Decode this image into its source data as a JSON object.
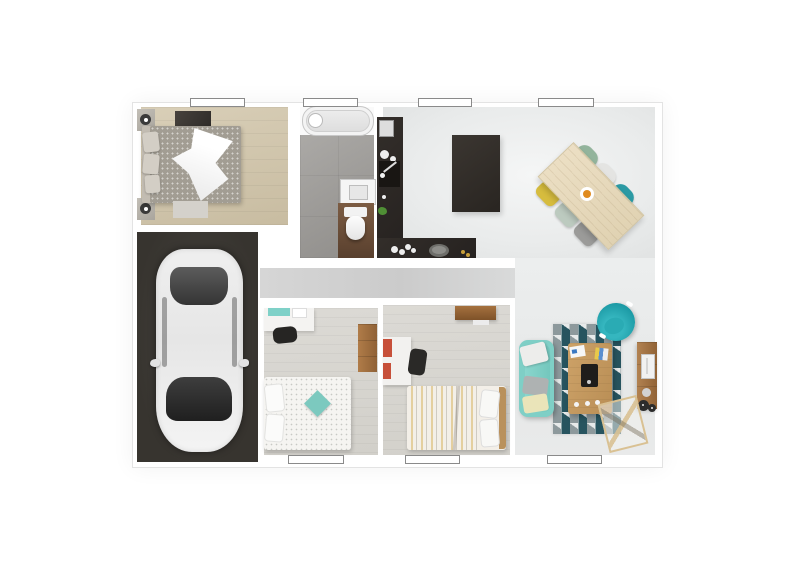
{
  "scene": {
    "type": "3d-floor-plan-render",
    "description": "Top-down 3D architectural render of a single-storey house with garage, no text labels",
    "rooms": [
      {
        "name": "bedroom-1",
        "floor": "light oak wood",
        "furniture": [
          "double-bed",
          "white-duvet",
          "nightstand-with-lamp-top",
          "nightstand-with-lamp-bottom",
          "dark-mat",
          "light-rug"
        ]
      },
      {
        "name": "bathroom",
        "floor": "gray concrete tile",
        "furniture": [
          "bathtub",
          "washbasin",
          "toilet",
          "wood-vanity-panel"
        ]
      },
      {
        "name": "kitchen",
        "floor": "light gray screed",
        "furniture": [
          "l-shaped-dark-counter",
          "kitchen-island",
          "microwave",
          "cooktop-sink",
          "plant",
          "dishes",
          "tray"
        ]
      },
      {
        "name": "dining-area",
        "floor": "light gray screed",
        "furniture": [
          "wood-dining-table",
          "chair-green",
          "chair-white",
          "chair-teal",
          "chair-yellow",
          "chair-mint",
          "chair-gray",
          "fruit-bowl"
        ]
      },
      {
        "name": "garage",
        "floor": "dark charcoal concrete",
        "furniture": [
          "white-car-top-view"
        ]
      },
      {
        "name": "hallway",
        "floor": "gray",
        "furniture": []
      },
      {
        "name": "bedroom-2",
        "floor": "gray-washed wood",
        "furniture": [
          "single-bed-dotted-duvet",
          "teal-diamond-pillow",
          "white-desk",
          "desk-chair",
          "oak-wardrobe"
        ]
      },
      {
        "name": "bedroom-3",
        "floor": "gray-washed wood",
        "furniture": [
          "single-bed-striped-duvet",
          "white-desk-red-drawers",
          "desk-chair",
          "oak-wall-shelf"
        ]
      },
      {
        "name": "living-room",
        "floor": "light gray screed",
        "furniture": [
          "teal-sofa",
          "pillows",
          "geometric-rug",
          "oak-coffee-table",
          "tablet",
          "papers",
          "teal-tub-armchair",
          "oak-tv-board",
          "tv",
          "records",
          "wire-basket"
        ]
      }
    ],
    "windows": {
      "top_wall": 4,
      "bottom_wall": 3,
      "style": "white bar with thin dark outline"
    }
  },
  "palette": {
    "wall_white": "#ffffff",
    "bedroom1_floor": "#cfc3aa",
    "bathroom_floor": "#9c9a97",
    "open_area_floor": "#edeff0",
    "hallway_floor": "#cccccc",
    "kids_room_floor": "#d8d6d1",
    "garage_floor": "#3b3834",
    "kitchen_counter": "#2b2724",
    "dining_table_wood": "#e8dcc0",
    "chair_green": "#93b49c",
    "chair_white": "#e4e4e2",
    "chair_teal": "#2b9aa4",
    "chair_yellow": "#d6bc3e",
    "chair_mint": "#bccabf",
    "chair_gray": "#9b9b99",
    "sofa_teal": "#7fcfc6",
    "armchair_teal": "#1b99a4",
    "rug_dark_teal": "#27545f",
    "rug_gray": "#8d999c",
    "coffee_table_oak": "#c69a62",
    "tv_stand_oak": "#ad7f4e",
    "accent_pillow_teal": "#7cc9bf",
    "desk_red": "#c7503a",
    "wood_shelf": "#a5713f",
    "bed3_stripe_yellow": "#e4cf9f",
    "car_body": "#efefef",
    "bowl_orange": "#e08b1e"
  }
}
